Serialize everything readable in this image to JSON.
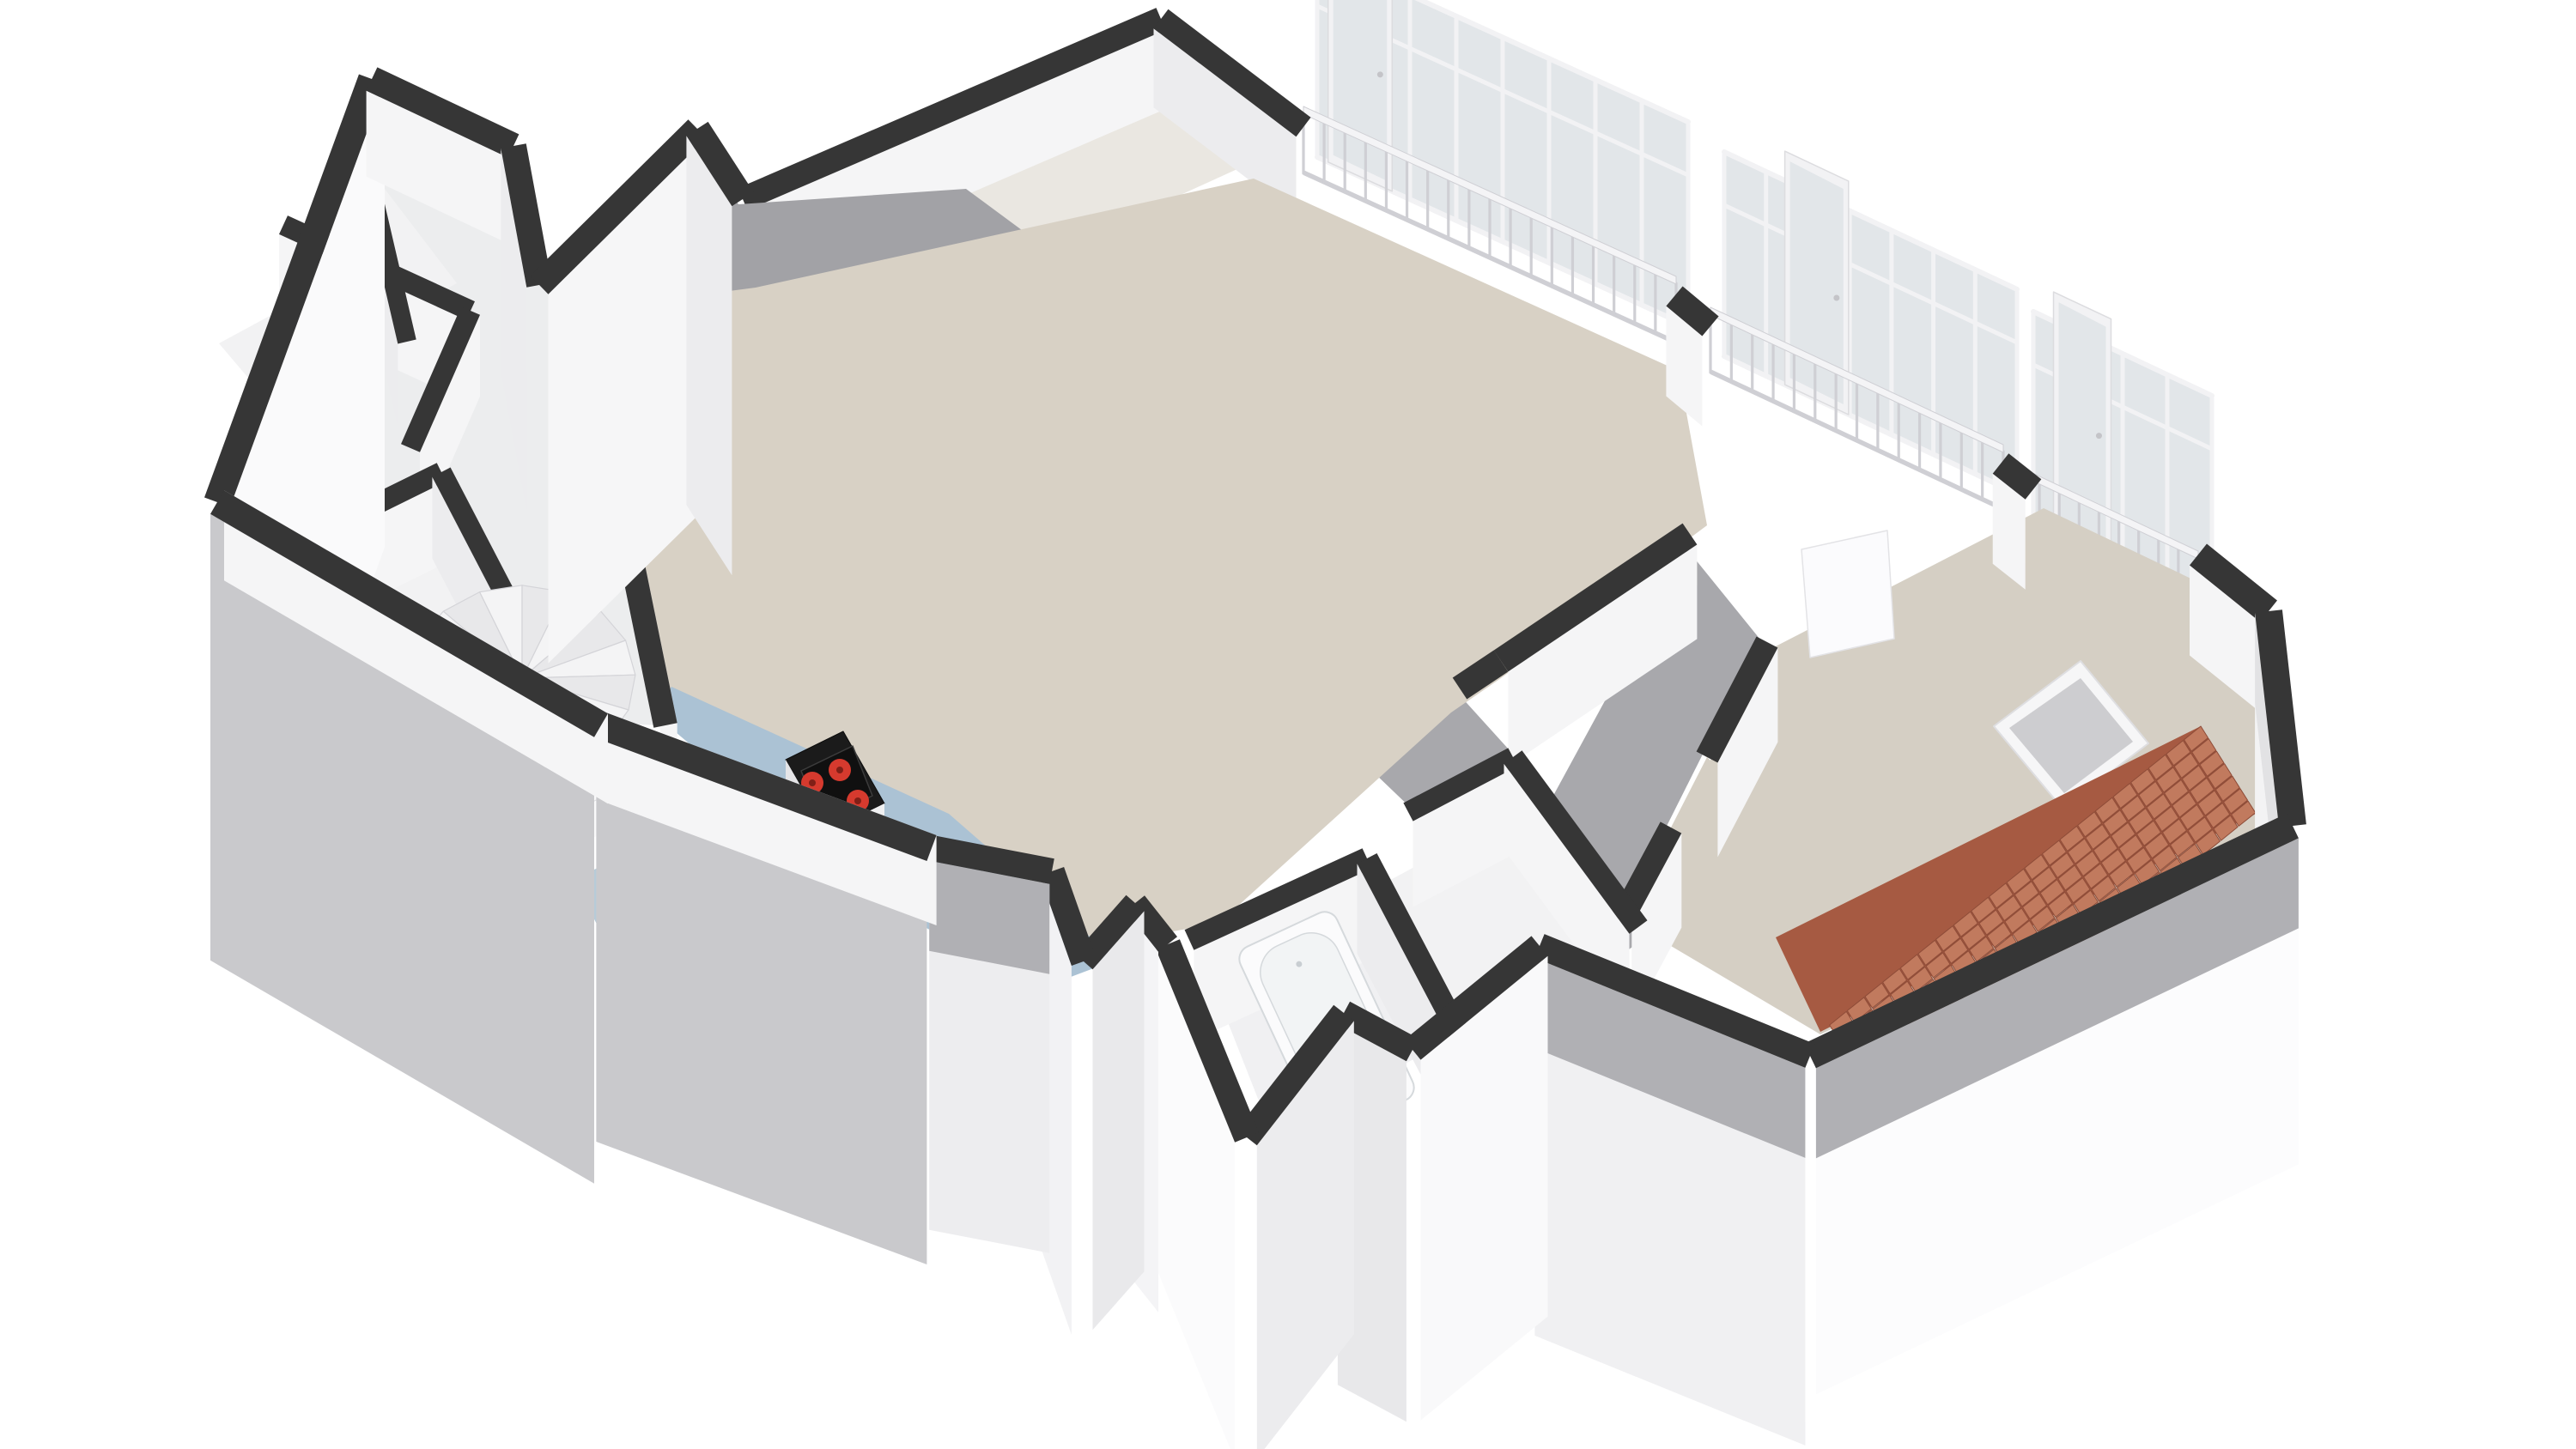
{
  "figure": {
    "kind": "3d-floorplan-render",
    "label": "Axonometric 3D floor plan of an apartment floor, white background, no text"
  },
  "colors": {
    "background": "#ffffff",
    "wallTop": "#363636",
    "wallFaceWhite": "#f5f5f6",
    "wallFaceSoft": "#ececee",
    "plinthGray": "#c9c9cc",
    "innerShadow": "#b0b0b4",
    "roofGray": "#a2a2a6",
    "corridorGray": "#a8a8ac",
    "floorLiving": "#d8d1c5",
    "floorEast": "#d5cfc4",
    "floorKitchen": "#abc2d4",
    "floorDormer": "#eae7e1",
    "floorRoom": "#f2f2f3",
    "floorBath": "#f0f0f2",
    "voidWhite": "#ffffff",
    "voidBlue": "#b7cbd8",
    "stairLight": "#f4f4f5",
    "stairDark": "#e8e8ea",
    "stairStroke": "#d4d4d8",
    "counterBlack": "#1b1b1b",
    "cabinetWhite": "#f0f0f1",
    "cabinetSide": "#e5e5e8",
    "burnerRed": "#d63a2e",
    "burnerCore": "#801f17",
    "tubWhite": "#fbfbfc",
    "tubInner": "#f2f4f5",
    "tubStroke": "#d5d9dc",
    "brickBase": "#a65a42",
    "brickTile": "#c17a5e",
    "brickGap": "#8e4c38",
    "glassPane": "#e2e6e9",
    "frameWhite": "#f2f2f4",
    "railWhite": "#f4f4f6",
    "railShade": "#cfcfd4",
    "skylightPane": "#cdcdd0",
    "skylightFrame": "#f6f6f7",
    "doorLeaf": "#fbfbfd",
    "accentRust": "#9b5a43"
  },
  "inventory": {
    "rooms": [
      "living-room",
      "kitchen-area",
      "east-bedroom",
      "bathroom",
      "dormer-loggia",
      "west-wing-closets",
      "hallway"
    ],
    "fixtures": [
      "spiral-staircase",
      "kitchen-island-counter",
      "cooktop",
      "bathtub",
      "skylight-panel",
      "tiled-roof-terrace"
    ],
    "cooktop_burners": 4,
    "balcony_railings": 3,
    "glazed-bays": 3,
    "glass_doors": 3
  }
}
